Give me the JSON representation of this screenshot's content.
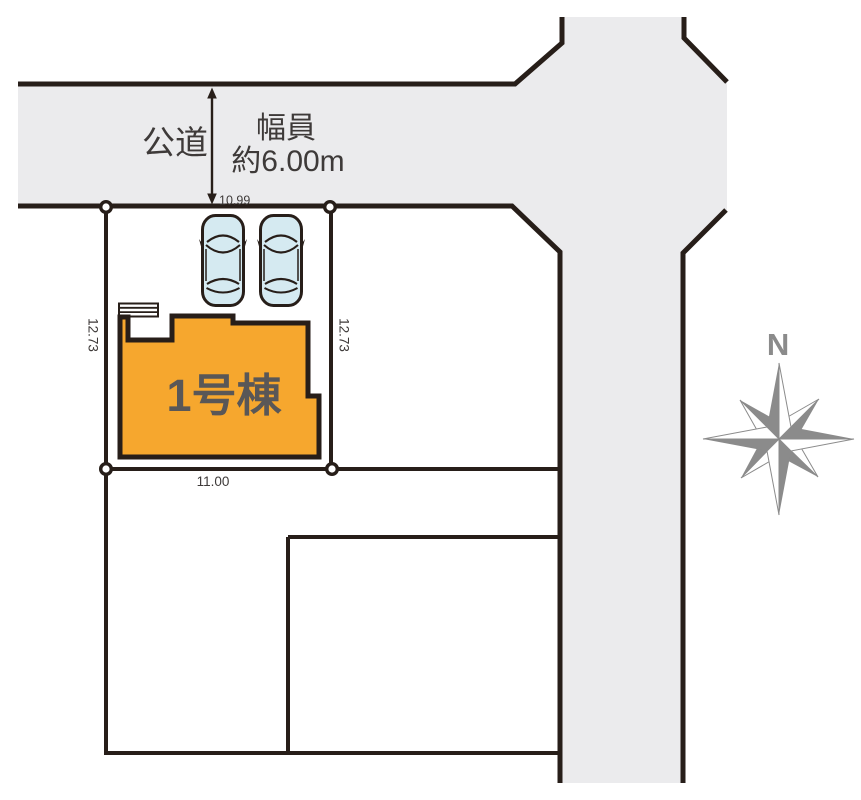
{
  "colors": {
    "background": "#ffffff",
    "road_fill": "#ebebed",
    "line": "#271e19",
    "building_fill": "#f6a72e",
    "building_label": "#595757",
    "dimension_text": "#3e3a39",
    "compass": "#8b8b8b",
    "car_fill": "#d5eaf1"
  },
  "road": {
    "name": "公道",
    "width_label_line1": "幅員",
    "width_label_line2": "約6.00m"
  },
  "plot": {
    "frontage_top": "10.99",
    "depth_left": "12.73",
    "depth_right": "12.73",
    "width_bottom": "11.00"
  },
  "building": {
    "name": "1号棟"
  },
  "compass": {
    "north_label": "N"
  },
  "icons": {
    "car": "car-top-view",
    "compass": "compass-rose-8-point",
    "road_width_arrow": "double-headed-vertical-arrow",
    "corner_marker": "survey-point-circle"
  }
}
